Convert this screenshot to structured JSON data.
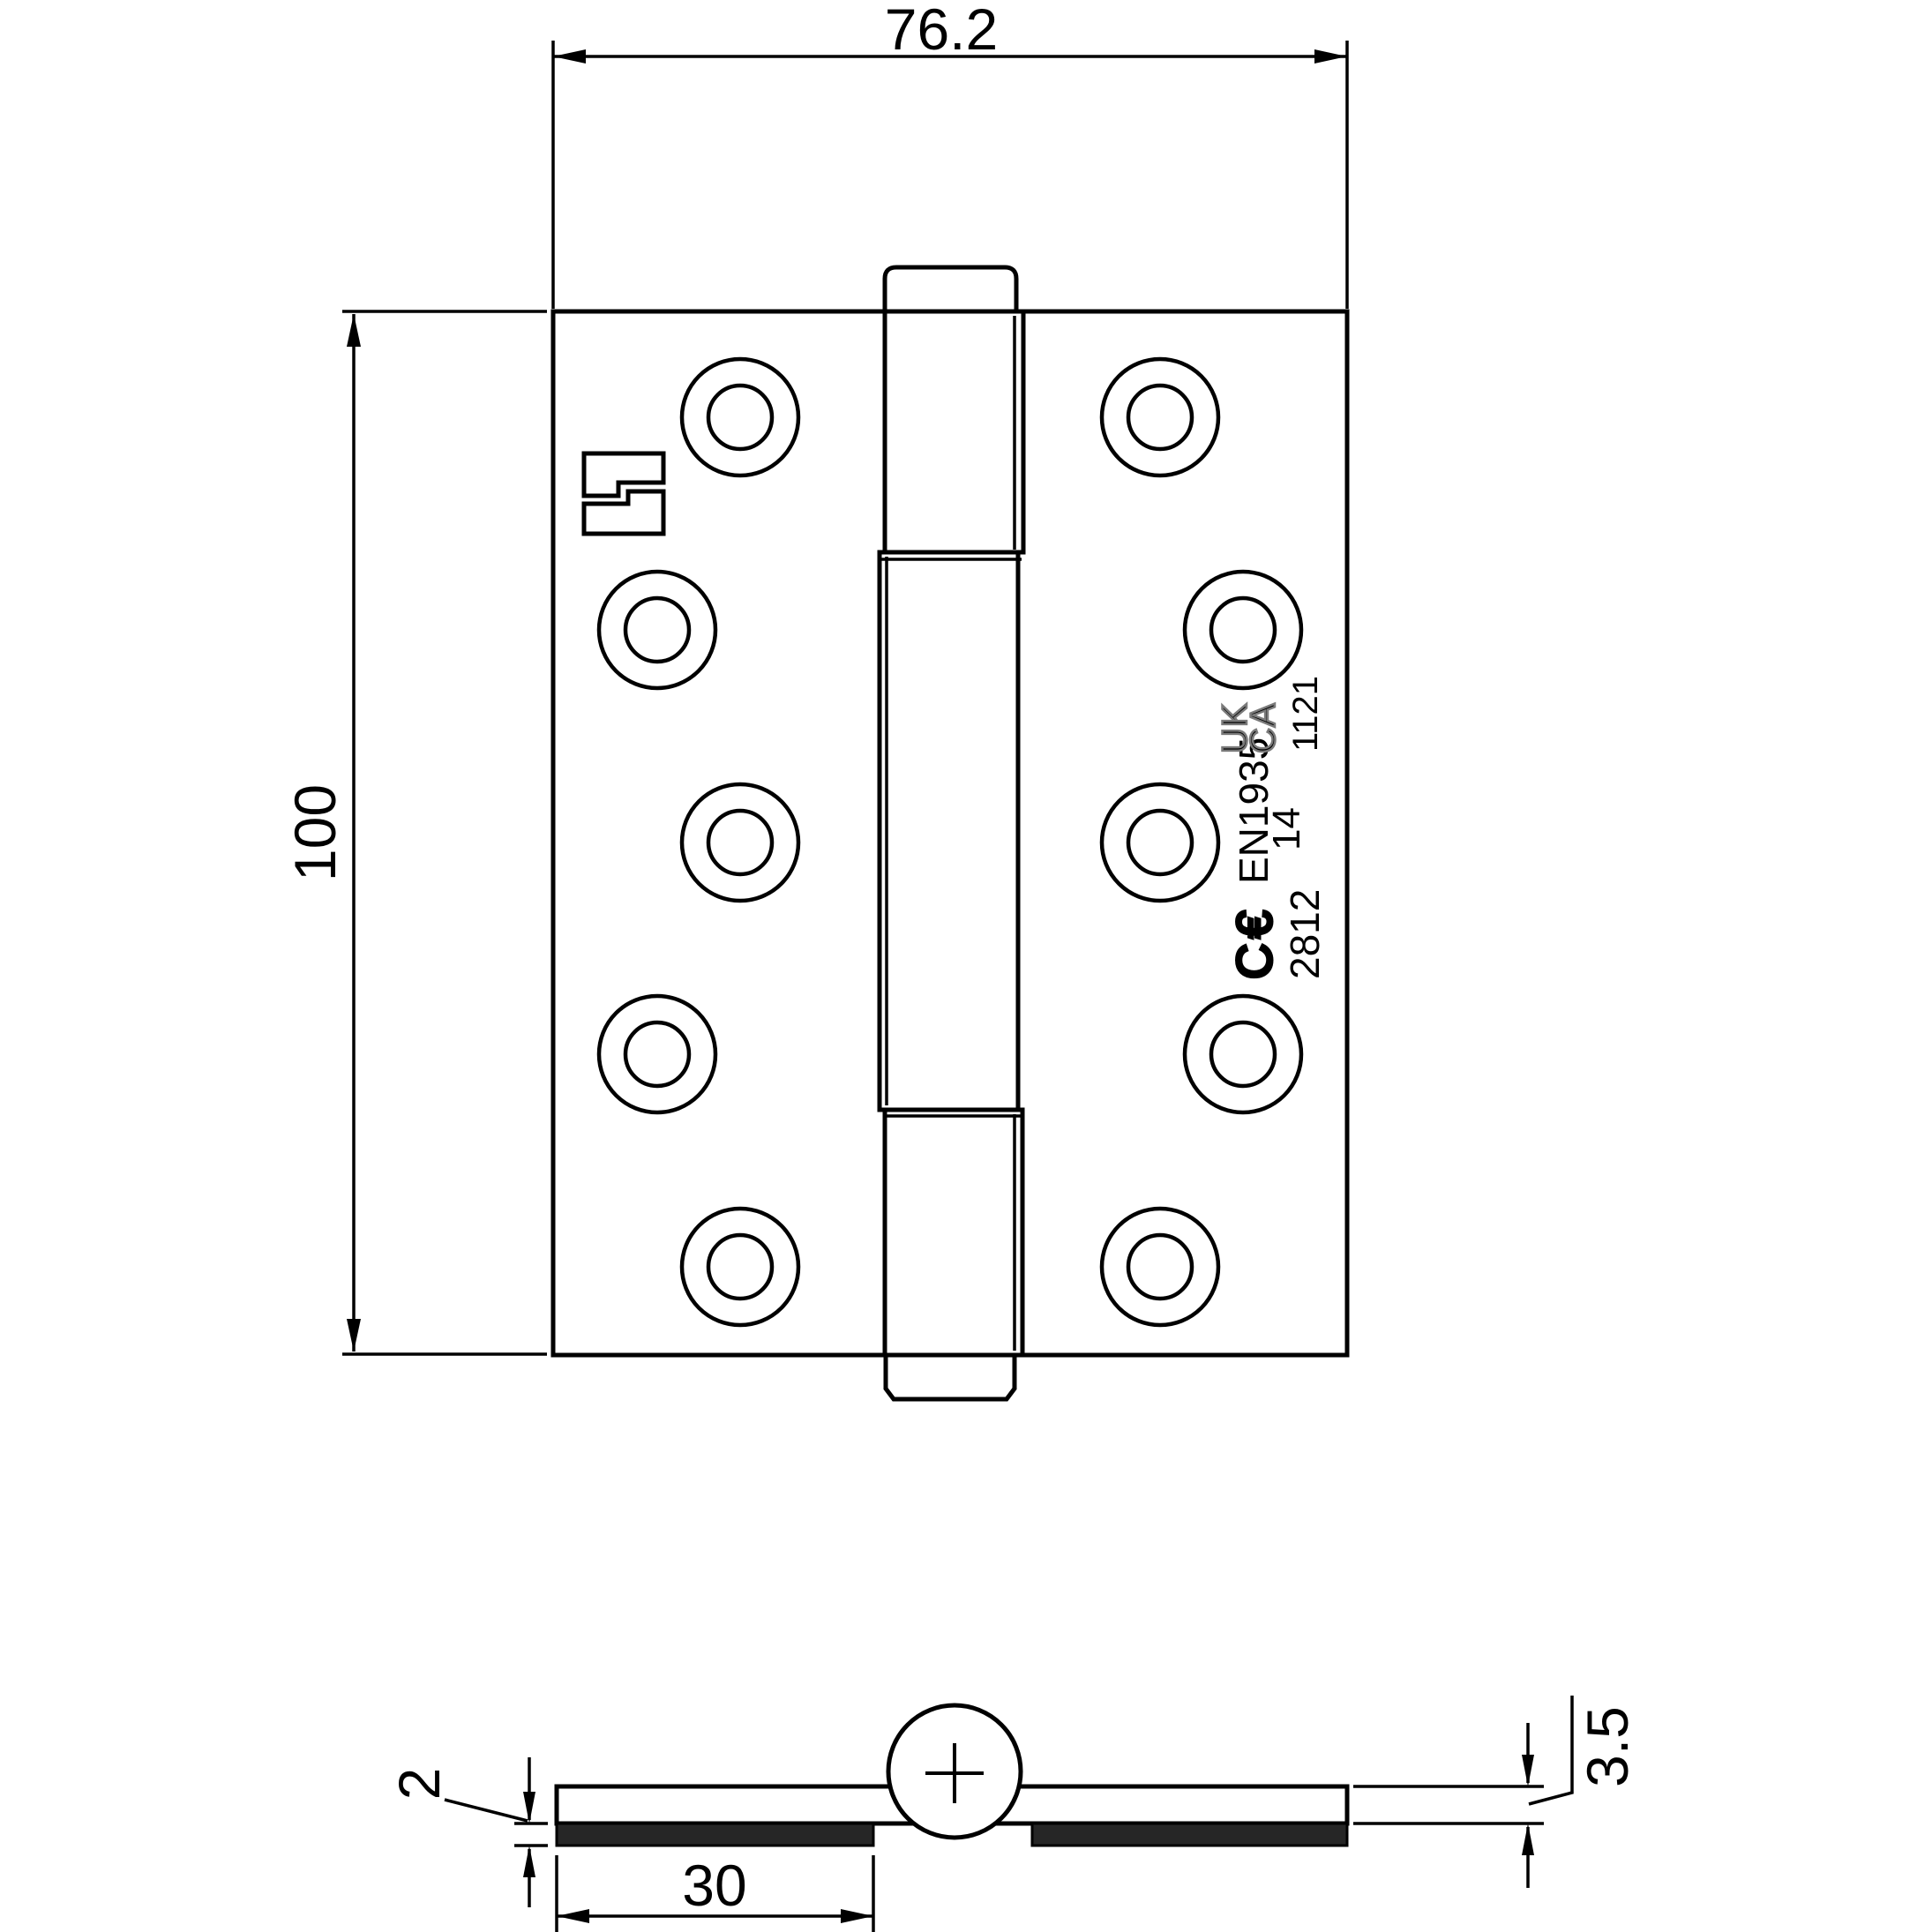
{
  "dimensions": {
    "width_label": "76.2",
    "height_label": "100",
    "strip_thickness_label": "2",
    "strip_width_label": "30",
    "leaf_thickness_label": "3.5"
  },
  "markings": {
    "ce_mark": "C€",
    "standard": "EN1935",
    "grade": "14",
    "ce_body_number": "2812",
    "ukca_line1": "UK",
    "ukca_line2": "CA",
    "ukca_body_number": "1121"
  },
  "colors": {
    "line": "#000000",
    "intumescent_strip": "#262626",
    "ukca_outline": "#7a7a7a"
  }
}
